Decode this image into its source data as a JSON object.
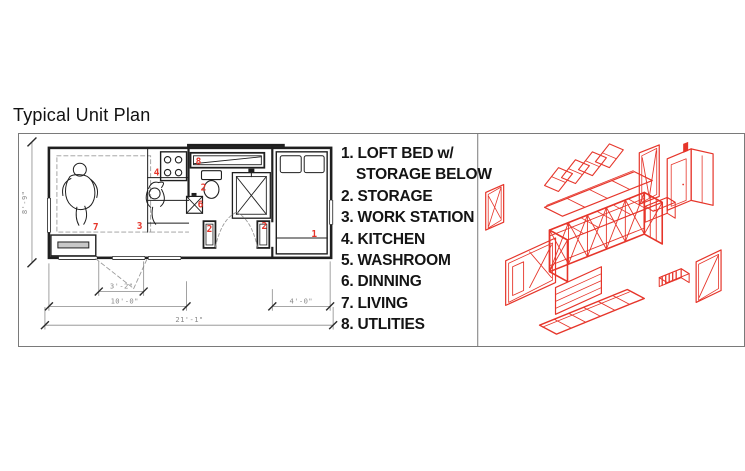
{
  "title": "Typical Unit Plan",
  "colors": {
    "red": "#e6352a",
    "ink": "#1f1f1f",
    "dash_gray": "#9b9b9b",
    "dim_gray": "#8a8a8a",
    "frame_border": "#7a7a7a"
  },
  "legend": {
    "items": [
      {
        "num": "1.",
        "line1": "LOFT BED w/",
        "line2": "STORAGE BELOW"
      },
      {
        "num": "2.",
        "line1": "STORAGE"
      },
      {
        "num": "3.",
        "line1": "WORK STATION"
      },
      {
        "num": "4.",
        "line1": "KITCHEN"
      },
      {
        "num": "5.",
        "line1": "WASHROOM"
      },
      {
        "num": "6.",
        "line1": "DINNING"
      },
      {
        "num": "7.",
        "line1": "LIVING"
      },
      {
        "num": "8.",
        "line1": "UTLITIES"
      }
    ]
  },
  "plan": {
    "room_numbers": {
      "living": "7",
      "work_station": "3",
      "kitchen": "4",
      "utilities": "8",
      "storage_toilet": "2",
      "dinning": "6",
      "storage_left": "2",
      "storage_right": "2",
      "loft_bed": "1"
    },
    "dimensions": {
      "height": "8'-9\"",
      "entry": "3'-2\"",
      "main_span": "10'-0\"",
      "bed_span": "4'-0\"",
      "total_span": "21'-1\""
    }
  }
}
